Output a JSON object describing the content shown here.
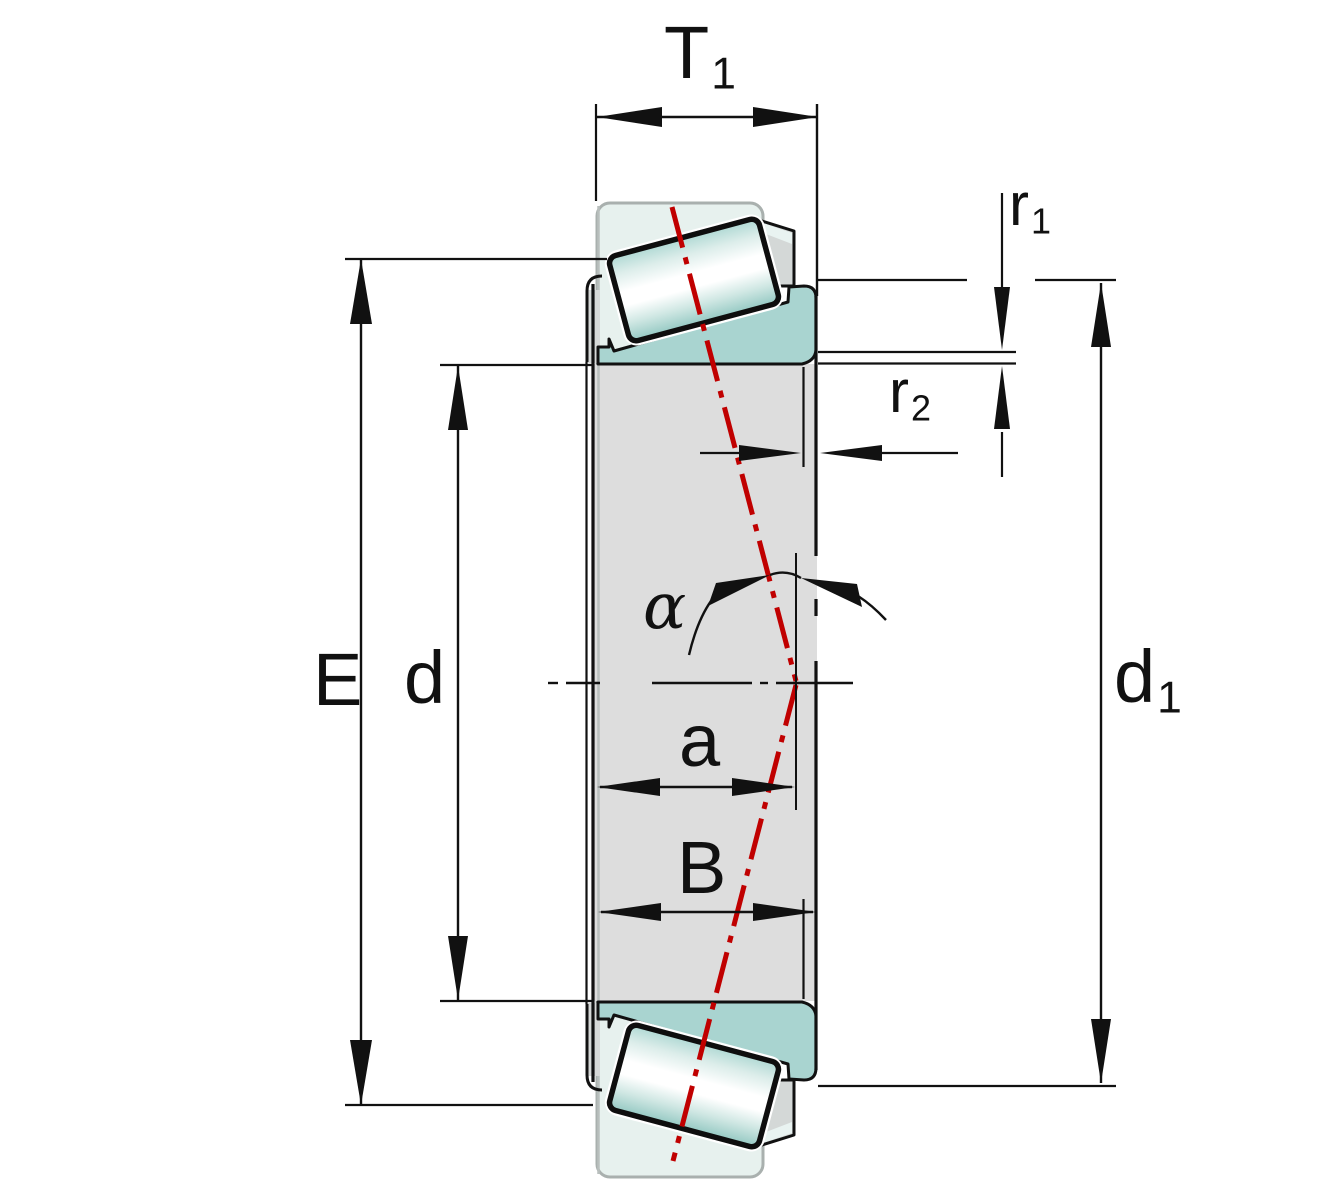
{
  "labels": {
    "t1": {
      "main": "T",
      "sub": "1"
    },
    "r1": {
      "main": "r",
      "sub": "1"
    },
    "r2": {
      "main": "r",
      "sub": "2"
    },
    "e": {
      "main": "E"
    },
    "d": {
      "main": "d"
    },
    "d1": {
      "main": "d",
      "sub": "1"
    },
    "a": {
      "main": "a"
    },
    "b": {
      "main": "B"
    },
    "alpha": {
      "main": "α"
    }
  },
  "colors": {
    "outline": "#111111",
    "centerline_red": "#c00000",
    "ring_teal": "#a9d4d0",
    "cage_pale": "#e7f1ee",
    "bore_gray": "#dddddd",
    "cage_bar_gray": "#d4d8d7",
    "background": "#ffffff"
  }
}
